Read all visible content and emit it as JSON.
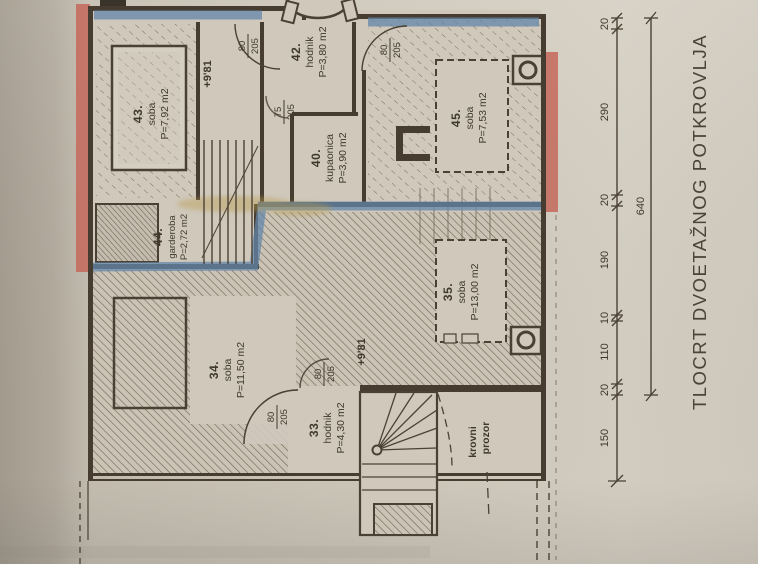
{
  "title": "TLOCRT DVOETAŽNOG POTKROVLJA",
  "colors": {
    "paper": "#cfc8bb",
    "ink": "#463d30",
    "red_pencil": "#c4695c",
    "blue_pencil": "#6487aa",
    "gold_glitter": "#b99b4e"
  },
  "rooms": {
    "r43": {
      "number": "43.",
      "name": "soba",
      "area": "P=7,92 m2"
    },
    "r42": {
      "number": "42.",
      "name": "hodnik",
      "area": "P=3,80 m2"
    },
    "r40": {
      "number": "40.",
      "name": "kupaonica",
      "area": "P=3,90 m2"
    },
    "r45": {
      "number": "45.",
      "name": "soba",
      "area": "P=7,53 m2"
    },
    "r44": {
      "number": "44.",
      "name": "garderoba",
      "area": "P=2,72 m2"
    },
    "r34": {
      "number": "34.",
      "name": "soba",
      "area": "P=11,50 m2"
    },
    "r33": {
      "number": "33.",
      "name": "hodnik",
      "area": "P=4,30 m2"
    },
    "r35": {
      "number": "35.",
      "name": "soba",
      "area": "P=13,00 m2"
    }
  },
  "doors": {
    "d43": {
      "w": "80",
      "h": "205"
    },
    "d42": {
      "w": "80",
      "h": "205"
    },
    "d40": {
      "w": "75",
      "h": "205"
    },
    "d33": {
      "w": "80",
      "h": "205"
    },
    "d34": {
      "w": "80",
      "h": "205"
    }
  },
  "levels": {
    "upper": "+9'81",
    "lower": "+9'81"
  },
  "annotations": {
    "roof_window_line1": "krovni",
    "roof_window_line2": "prozor"
  },
  "dimensions": {
    "chain": [
      "20",
      "290",
      "20",
      "190",
      "10",
      "110",
      "20",
      "150"
    ],
    "overall": "640"
  }
}
